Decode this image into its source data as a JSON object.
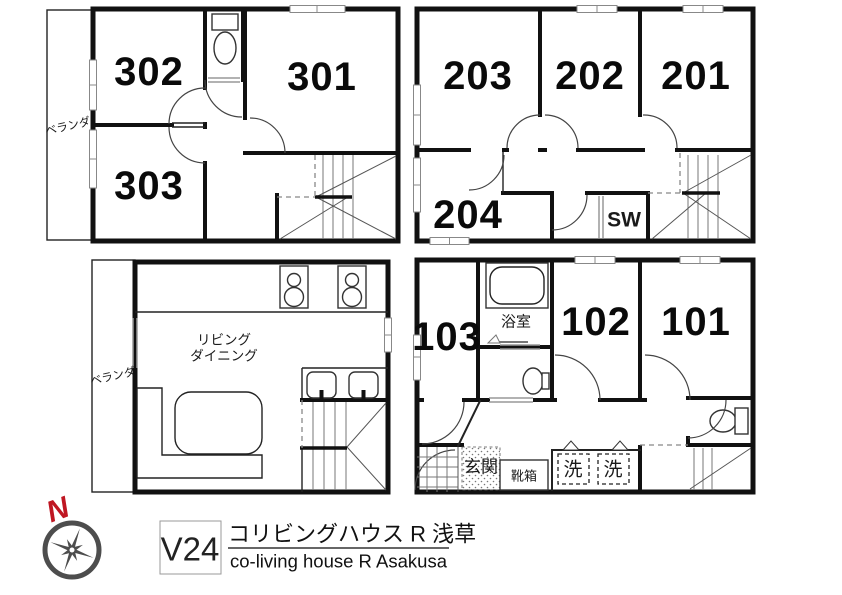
{
  "document": {
    "code": "V24",
    "title_ja": "コリビングハウス R 浅草",
    "title_en": "co-living house R Asakusa",
    "north_label": "N"
  },
  "colors": {
    "wall": "#111111",
    "north_red": "#bf1622",
    "compass_gray": "#4d4d4d"
  },
  "floor_3f": {
    "rooms": {
      "r302": "302",
      "r301": "301",
      "r303": "303"
    },
    "balcony_label": "ベランダ"
  },
  "floor_2f": {
    "rooms": {
      "r203": "203",
      "r202": "202",
      "r201": "201",
      "r204": "204"
    },
    "closet_label": "SW"
  },
  "floor_living": {
    "living_label_line1": "リビング",
    "living_label_line2": "ダイニング",
    "balcony_label": "ベランダ"
  },
  "floor_1f": {
    "rooms": {
      "r103": "103",
      "r102": "102",
      "r101": "101"
    },
    "bath_label": "浴室",
    "entrance_label": "玄関",
    "shoebox_label": "靴箱",
    "washer_label_1": "洗",
    "washer_label_2": "洗"
  }
}
